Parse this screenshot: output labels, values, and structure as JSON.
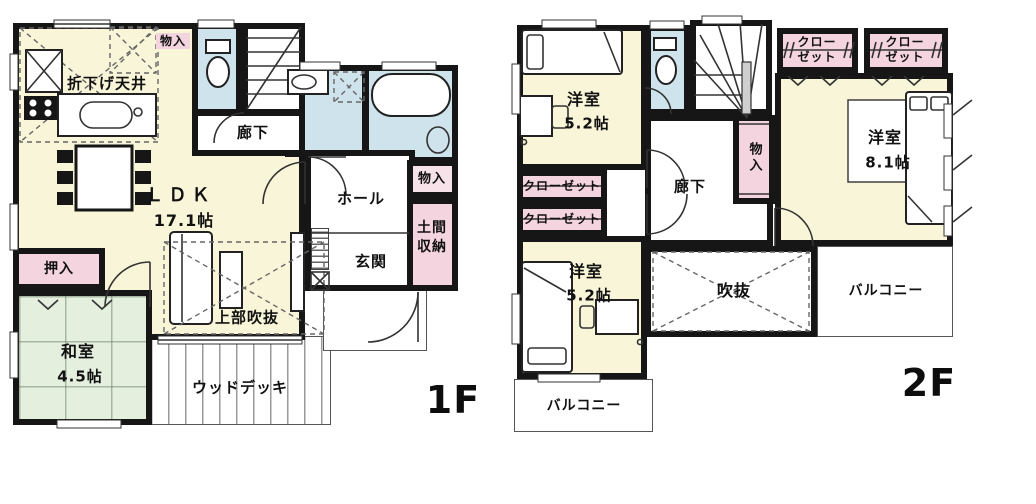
{
  "colors": {
    "wall": "#161616",
    "cream": "#f8f5d8",
    "pink": "#f4d4df",
    "pink_light": "#f8e2ea",
    "blue": "#cfe3ec",
    "green": "#e4efde",
    "bg": "#ffffff"
  },
  "f1": {
    "tag": "1F",
    "labels": {
      "monoire_top": "物入",
      "oridage": "折下げ天井",
      "rouka": "廊下",
      "ldk_name": "ＬＤＫ",
      "ldk_size": "17.1帖",
      "monoire_side": "物入",
      "hall": "ホール",
      "doma_line1": "土間",
      "doma_line2": "収納",
      "genkan": "玄関",
      "oshiire": "押入",
      "washitsu_name": "和室",
      "washitsu_size": "4.5帖",
      "joubu_fukinuke": "上部吹抜",
      "wood_deck": "ウッドデッキ"
    }
  },
  "f2": {
    "tag": "2F",
    "labels": {
      "yoshitsu_nw_name": "洋室",
      "yoshitsu_nw_size": "5.2帖",
      "closet_w1": "クローゼット",
      "closet_w2": "クローゼット",
      "rouka": "廊下",
      "monoire": "物入",
      "closet_ne1_line1": "クロー",
      "closet_ne1_line2": "ゼット",
      "closet_ne2_line1": "クロー",
      "closet_ne2_line2": "ゼット",
      "yoshitsu_e_name": "洋室",
      "yoshitsu_e_size": "8.1帖",
      "fukinuke": "吹抜",
      "balcony_e": "バルコニー",
      "yoshitsu_sw_name": "洋室",
      "yoshitsu_sw_size": "5.2帖",
      "balcony_s": "バルコニー"
    }
  }
}
